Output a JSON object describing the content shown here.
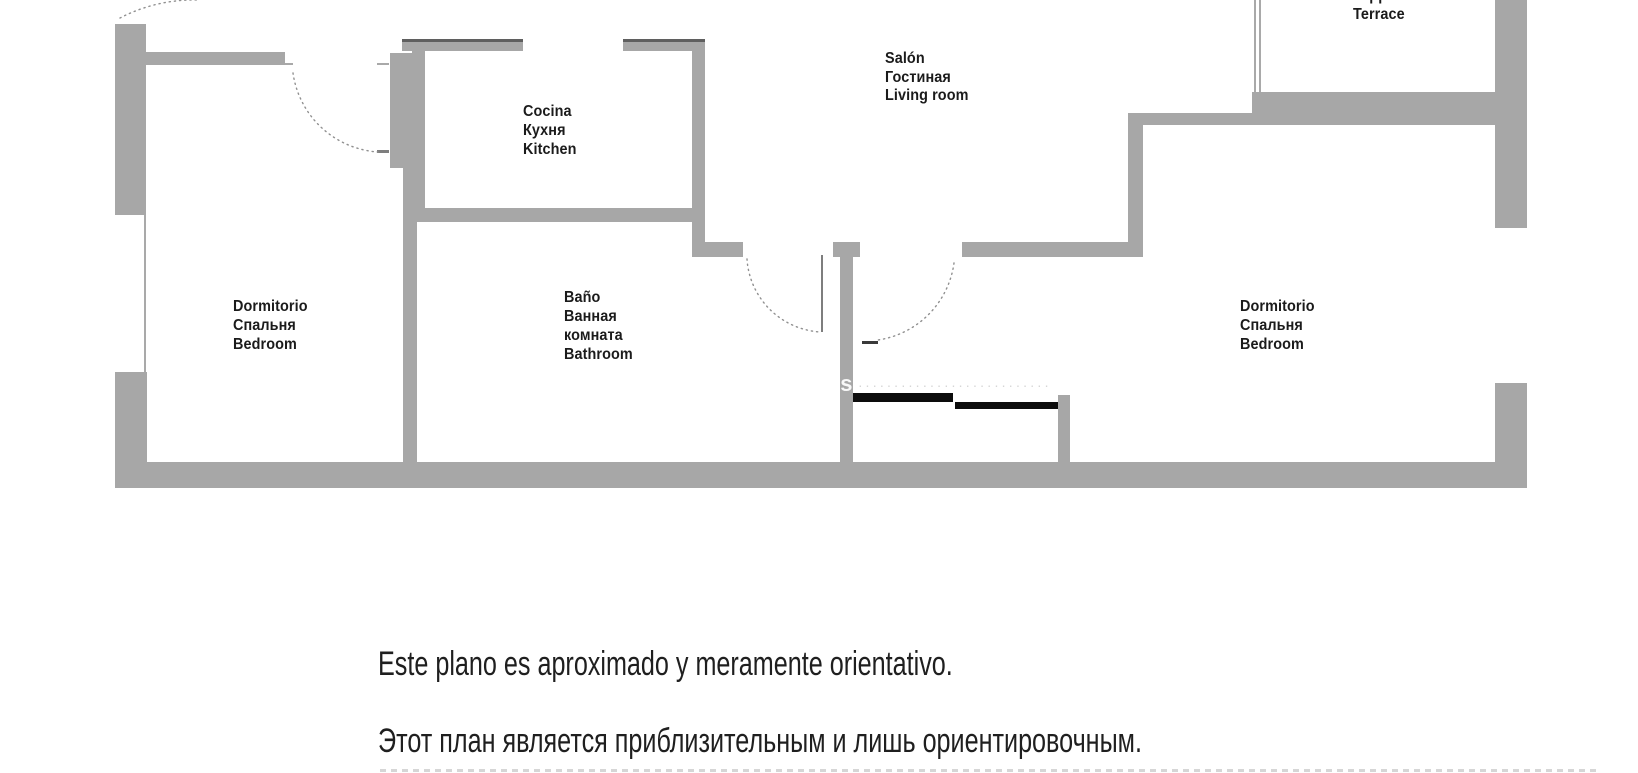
{
  "plan": {
    "rooms": [
      {
        "id": "bedroom-left",
        "lines": [
          "Dormitorio",
          "Спальня",
          "Bedroom"
        ]
      },
      {
        "id": "kitchen",
        "lines": [
          "Cocina",
          "Кухня",
          "Kitchen"
        ]
      },
      {
        "id": "bathroom",
        "lines": [
          "Baño",
          "Ванная",
          "комната",
          "Bathroom"
        ]
      },
      {
        "id": "living-room",
        "lines": [
          "Salón",
          "Гостиная",
          "Living room"
        ]
      },
      {
        "id": "terrace",
        "lines": [
          "Terraza",
          "Терраса",
          "Terrace"
        ]
      },
      {
        "id": "bedroom-right",
        "lines": [
          "Dormitorio",
          "Спальня",
          "Bedroom"
        ]
      }
    ],
    "watermark": "ils"
  },
  "disclaimer": {
    "es": "Este plano es aproximado y meramente orientativo.",
    "ru": "Этот план является приблизительным и лишь ориентировочным."
  },
  "colors": {
    "wall": "#a7a7a7",
    "wall_dark_edge": "#5f5f5f",
    "black_bar": "#0c0c0c",
    "text": "#1b1b1b",
    "dotted_line": "#909090",
    "background": "#ffffff"
  }
}
